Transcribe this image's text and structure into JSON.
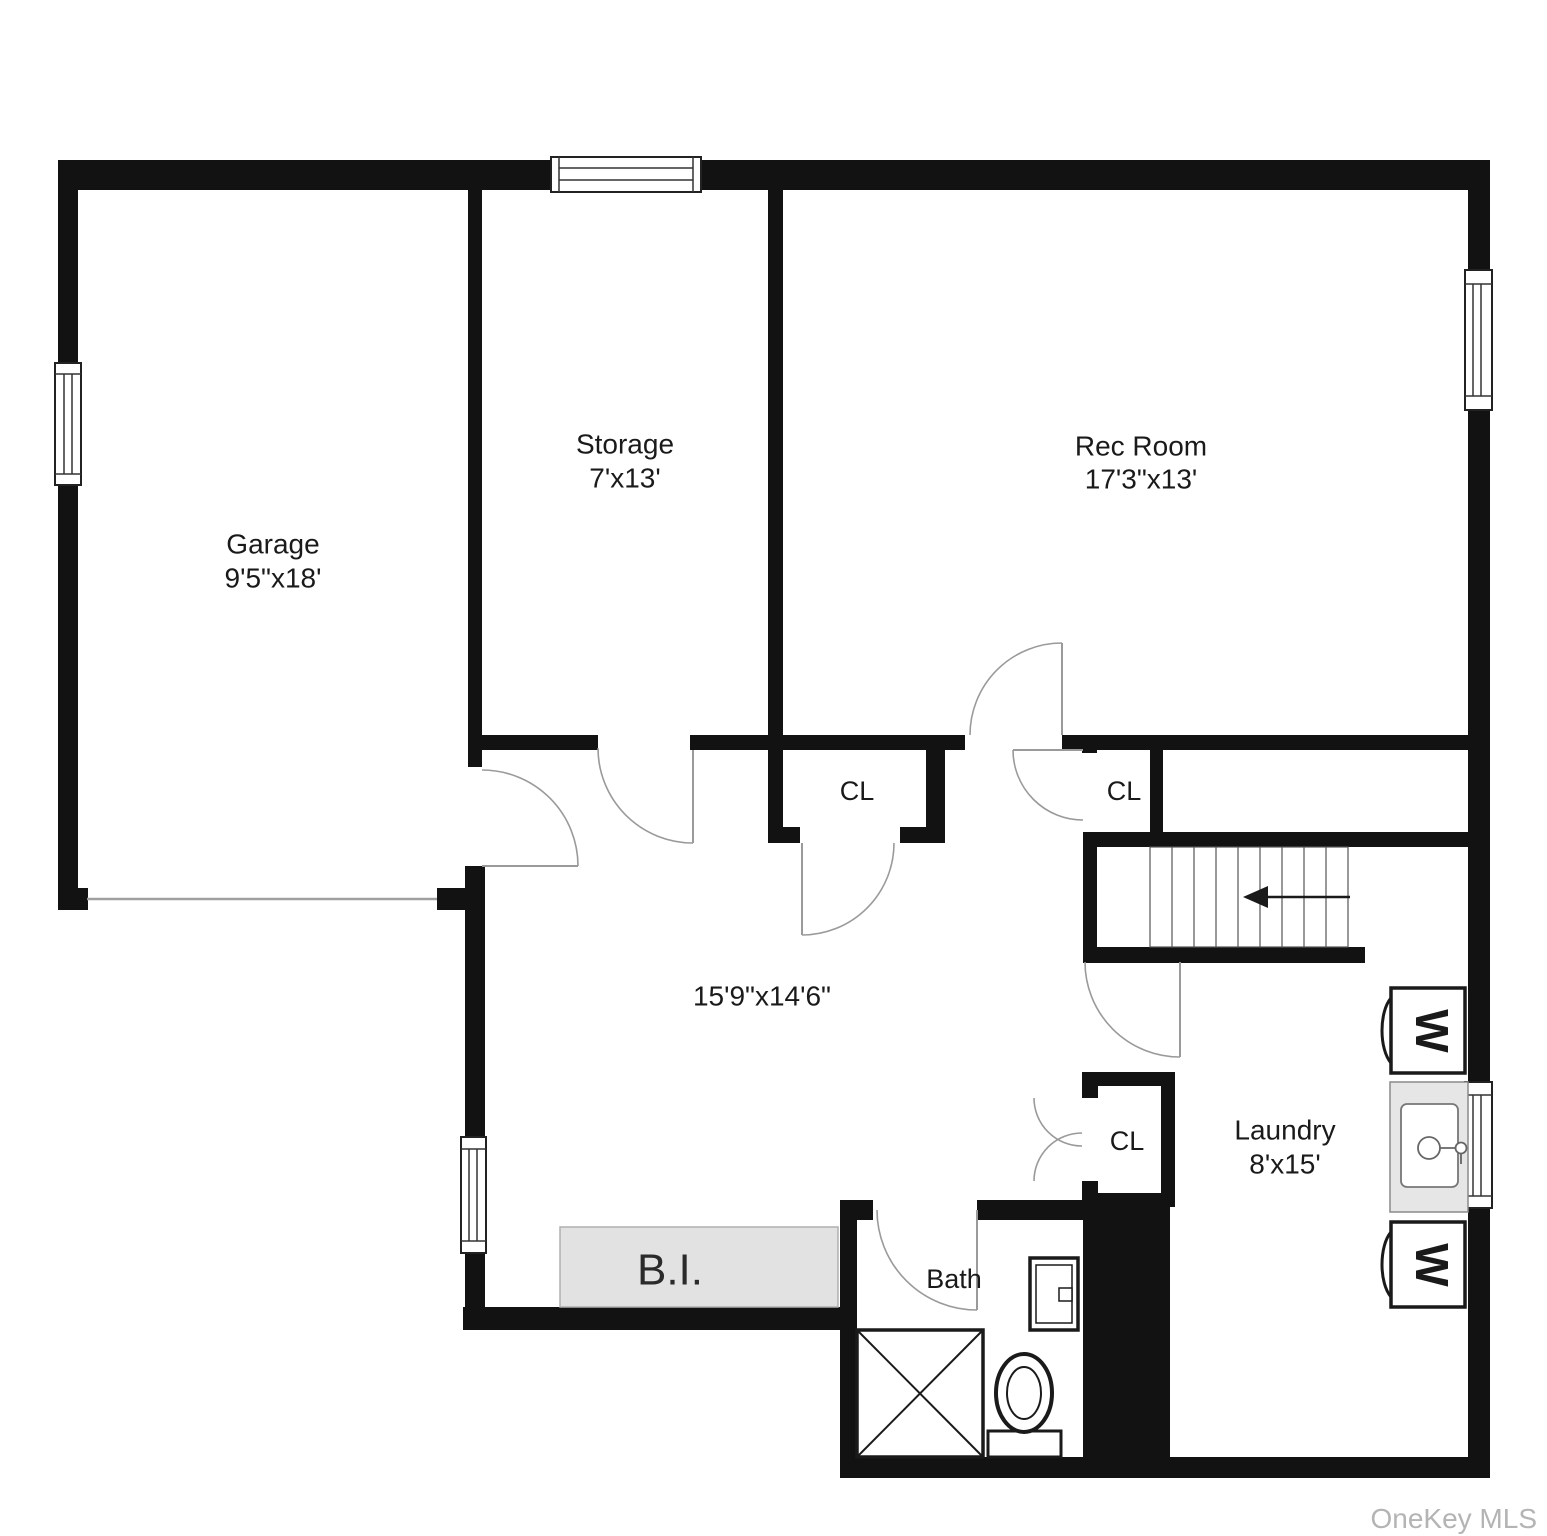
{
  "plan": {
    "watermark": "OneKey MLS",
    "rooms": {
      "garage": {
        "name": "Garage",
        "dims": "9'5\"x18'"
      },
      "storage": {
        "name": "Storage",
        "dims": "7'x13'"
      },
      "rec_room": {
        "name": "Rec Room",
        "dims": "17'3\"x13'"
      },
      "center_room": {
        "dims": "15'9\"x14'6\""
      },
      "laundry": {
        "name": "Laundry",
        "dims": "8'x15'"
      },
      "bath": {
        "name": "Bath"
      },
      "closet1": {
        "name": "CL"
      },
      "closet2": {
        "name": "CL"
      },
      "closet3": {
        "name": "CL"
      }
    },
    "fixtures": {
      "built_in": "B.I.",
      "washer": "W"
    }
  },
  "colors": {
    "wall": "#121212",
    "bg": "#ffffff",
    "builtin": "#e2e2e2",
    "sinkgray": "#e6e6e6",
    "door": "#9a9a9a",
    "watermark": "#b4b4b4",
    "text": "#1a1a1a"
  }
}
